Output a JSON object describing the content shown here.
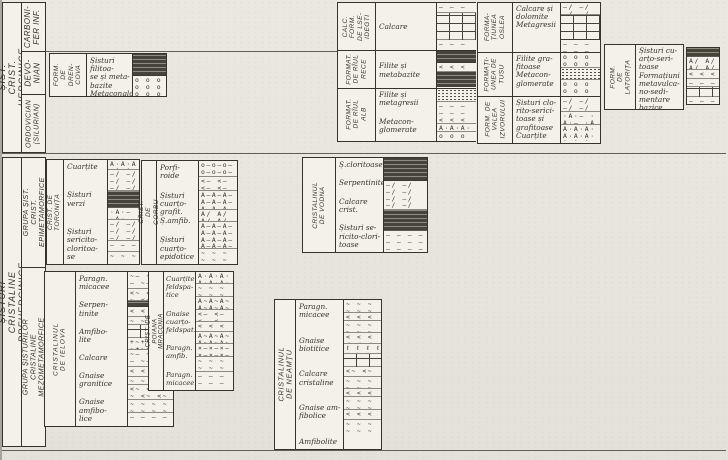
{
  "figure_colors": {
    "ink": "#35332c",
    "paper": "#e8e6df"
  },
  "axis": {
    "herc_group": "ȘIST. CRIST. HERCINICE",
    "periods": [
      "CARBONI-\nFER INF.",
      "DEVO-\nNIAN",
      "ORDOVICIAN\n(SILURIAN)"
    ],
    "pre_group": "ȘISTURI CRISTALINE PREHERCINICE",
    "sub_epi": "GRUPA ȘIST. CRIST.\nEPIMETAMORFICE",
    "sub_mezo": "GRUPA ȘISTURILOR CRISTALINE\nMEZOMETAMORFICE"
  },
  "blocks": {
    "drencova": {
      "label": "FORM.\nDE\nDREN-\nCOVA",
      "rows": [
        "Șisturi filitoa-\nse și meta-\nbazite",
        "Metaconglom."
      ],
      "lith": [
        {
          "p": "dark",
          "h": 22
        },
        {
          "p": "circles",
          "h": 20
        }
      ]
    },
    "raul": {
      "label_calc": "CALC. FORM.\nDE LSE-\nIDEGTI",
      "label_rece": "FORMAT.\nDE RÎUL\nRECE",
      "label_alb": "FORMAT.\nDE RÎUL\nALB",
      "rows": [
        "Calcare",
        "Filite și\nmetabazite",
        "Filite și\nmetagresii",
        "Metacon-\nglomerate"
      ],
      "lith_r1": [
        {
          "p": "dash",
          "h": 10
        },
        {
          "p": "brick",
          "h": 27
        },
        {
          "p": "dash",
          "h": 9
        }
      ],
      "lith_r2": [
        {
          "p": "dark",
          "h": 12
        },
        {
          "p": "vees",
          "h": 9
        },
        {
          "p": "dark",
          "h": 15
        }
      ],
      "lith_r3": [
        {
          "p": "speckle",
          "h": 13
        },
        {
          "p": "dash",
          "h": 13
        }
      ],
      "lith_r4": [
        {
          "p": "vees",
          "h": 8
        },
        {
          "p": "aaa",
          "h": 8
        },
        {
          "p": "circles",
          "h": 9
        }
      ]
    },
    "oslea_group": {
      "label_oslea": "FORMA-\nȚIUNEA\nOSLEA",
      "label_tusu": "FORMAȚI-\nUNEA DE\nTUSU",
      "label_izvor": "FORM. DE\nVALEA\nIZVORULUI",
      "rows": [
        "Calcare și\ndolomite\nMetagresii",
        "Filite gra-\nfitoase\nMetacon-\nglomerate",
        "Șisturi clo-\nrito-serici-\ntoase și\ngrafitoase\nCuarțite"
      ],
      "lith_r1": [
        {
          "p": "slash",
          "h": 12
        },
        {
          "p": "brick",
          "h": 25
        },
        {
          "p": "dash",
          "h": 13
        }
      ],
      "lith_r2": [
        {
          "p": "circles",
          "h": 15
        },
        {
          "p": "speckle",
          "h": 12
        },
        {
          "p": "circles",
          "h": 15
        }
      ],
      "lith_r3": [
        {
          "p": "slash",
          "h": 15
        },
        {
          "p": "adot",
          "h": 13
        },
        {
          "p": "aaa",
          "h": 16
        }
      ]
    },
    "latorita": {
      "label": "FORM. DE\nLATORIȚA",
      "rows": [
        "Șisturi cu-\narțo-seri-\ntoase",
        "Formațiuni\nmetavulca-\nno-sedi-\nmentare",
        "bazice"
      ],
      "lith": [
        {
          "p": "dark",
          "h": 9
        },
        {
          "p": "aslash",
          "h": 13
        },
        {
          "p": "vees",
          "h": 9
        },
        {
          "p": "dash",
          "h": 8
        },
        {
          "p": "brick",
          "h": 10
        },
        {
          "p": "dash",
          "h": 6
        }
      ]
    },
    "toronita": {
      "label": "CRIST. DE TORONIȚA",
      "rows": [
        "Cuarțite",
        "Șisturi\nverzi",
        "Șisturi\nsericito-\ncloritoa-\nse"
      ],
      "lith": [
        {
          "p": "aaa",
          "h": 10
        },
        {
          "p": "slash",
          "h": 21
        },
        {
          "p": "dark",
          "h": 17
        },
        {
          "p": "adot",
          "h": 12
        },
        {
          "p": "slash",
          "h": 21
        },
        {
          "p": "dash",
          "h": 11
        },
        {
          "p": "tilde",
          "h": 10
        }
      ]
    },
    "corbu": {
      "label": "CRIST. DE CORBU",
      "rows": [
        "Porfi-\nroide",
        "Șisturi\ncuarțo-\ngrafit.\nȘ.amfib.",
        "Șisturi\ncuarțo-\nepidotice"
      ],
      "lith": [
        {
          "p": "circledash",
          "h": 16
        },
        {
          "p": "veedash",
          "h": 14
        },
        {
          "p": "adash",
          "h": 19
        },
        {
          "p": "aslash",
          "h": 12
        },
        {
          "p": "adash",
          "h": 27
        },
        {
          "p": "tilde",
          "h": 13
        }
      ]
    },
    "vodna": {
      "label": "CRISTALINUL\nDE VODNA",
      "rows": [
        "Ș.cloritoase",
        "Serpentinite",
        "Calcare crist.",
        "Șisturi se-\nricito-clori-\ntoase"
      ],
      "lith": [
        {
          "p": "dark",
          "h": 23
        },
        {
          "p": "slash",
          "h": 29
        },
        {
          "p": "dark",
          "h": 21
        },
        {
          "p": "dash",
          "h": 19
        }
      ]
    },
    "ielova": {
      "label": "CRISTALINUL DE IELOVA",
      "rows": [
        "Paragn.\nmicacee",
        "Serpen-\ntinite",
        "Amfibo-\nlite",
        "Calcare",
        "Gnaise\ngranitice",
        "Gnaise\namfibo-\nlice"
      ],
      "lith": [
        {
          "p": "tildedash",
          "h": 17
        },
        {
          "p": "veetilde",
          "h": 12
        },
        {
          "p": "dark",
          "h": 6
        },
        {
          "p": "vees",
          "h": 10
        },
        {
          "p": "tilde",
          "h": 8
        },
        {
          "p": "brick",
          "h": 13
        },
        {
          "p": "plus",
          "h": 12
        },
        {
          "p": "tildedash",
          "h": 17
        },
        {
          "p": "vees",
          "h": 10
        },
        {
          "p": "tilde",
          "h": 8
        },
        {
          "p": "veetilde",
          "h": 15
        },
        {
          "p": "tilde",
          "h": 13
        },
        {
          "p": "dash",
          "h": 10
        }
      ]
    },
    "mraconia": {
      "label": "CRIST. DE POIANA MRACONIA",
      "rows": [
        "Cuarțite\nfeldspa-\ntice",
        "Gnaise\ncuarțo-\nfeldspat.",
        "Paragn.\namfib.",
        "Paragn.\nmicacee"
      ],
      "lith": [
        {
          "p": "aaa",
          "h": 12
        },
        {
          "p": "tilde",
          "h": 13
        },
        {
          "p": "atilde",
          "h": 13
        },
        {
          "p": "veedash",
          "h": 12
        },
        {
          "p": "vees",
          "h": 10
        },
        {
          "p": "atilde",
          "h": 12
        },
        {
          "p": "xdash",
          "h": 13
        },
        {
          "p": "tilde",
          "h": 15
        },
        {
          "p": "dash",
          "h": 12
        }
      ]
    },
    "neamtu": {
      "label": "CRISTALINUL DE NEAMȚU",
      "rows": [
        "Paragn.\nmicacee",
        "Gnaise\nbiotitice",
        "Calcare\ncristaline",
        "Gnaise am-\nfibolice",
        "Amfibolite"
      ],
      "lith": [
        {
          "p": "tilde",
          "h": 13
        },
        {
          "p": "vees",
          "h": 8
        },
        {
          "p": "tilde",
          "h": 12
        },
        {
          "p": "vees",
          "h": 11
        },
        {
          "p": "lls",
          "h": 10
        },
        {
          "p": "brick",
          "h": 13
        },
        {
          "p": "veetilde",
          "h": 10
        },
        {
          "p": "tilde",
          "h": 12
        },
        {
          "p": "vees",
          "h": 8
        },
        {
          "p": "tilde",
          "h": 13
        },
        {
          "p": "vees",
          "h": 10
        },
        {
          "p": "tilde",
          "h": 12
        }
      ]
    }
  }
}
